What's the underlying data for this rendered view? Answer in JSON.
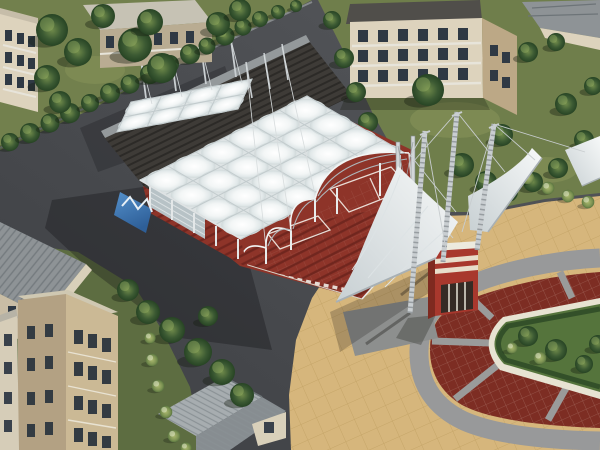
{
  "scene": {
    "kind": "3d-architectural-aerial-render",
    "subject": "tensile membrane canopy sports complex with grandstand courts, entrance pylons, oval paved plaza and apartment blocks"
  },
  "palette": {
    "asphalt": "#4c4e52",
    "asphalt_dark": "#3a3c3f",
    "grass_tl": "#72804d",
    "grass_tr": "#6f7e4b",
    "grass_bl": "#5d6d41",
    "membrane": "#dde3e4",
    "membrane_shade": "#c3ccce",
    "seam": "#c2cbcd",
    "court_red": "#8e3429",
    "court_red_dark": "#6e241d",
    "plaza_red": "#7d2d23",
    "plaza_tan": "#d6b67c",
    "tan_line": "#c1a163",
    "ring_gray": "#98999a",
    "island_green": "#55743c",
    "island_curb": "#e7e3d2",
    "hedge_green": "#2e4a26",
    "kiosk_red": "#a8382d",
    "kiosk_cream": "#e8decb",
    "kiosk_side": "#7e2a20",
    "pool_blue": "#3f7ec0",
    "steel": "#c9ced1",
    "steel_dark": "#7d8488",
    "deck": "#3e3b37",
    "deck_curb": "#94999b",
    "wall_cream": "#ddd3bd",
    "wall_shade": "#b9ac92",
    "brick": "#bca886",
    "brick_shade": "#b3a183",
    "brick_lit": "#cbb995",
    "roof_dark": "#504e4a",
    "roof_gray": "#8e9396",
    "roof_b3_light": "#a7adb0",
    "roof_b3_dark": "#878d91",
    "window": "#2f3944",
    "trim": "#e7e4da",
    "fascia": "#d9d0ba",
    "path_gray": "#8d8f8e"
  },
  "objects": {
    "main_canopy": "white quilted tensile roof over red grandstand courts",
    "secondary_canopy": "small arched membrane shelter on terrace",
    "entrance": "lattice steel pylons with cable-stayed walkway canopies and striped ticket kiosk",
    "plaza": "oval ring road with red paving segments and planted island",
    "context": "apartment buildings, tree rows, asphalt roads"
  }
}
